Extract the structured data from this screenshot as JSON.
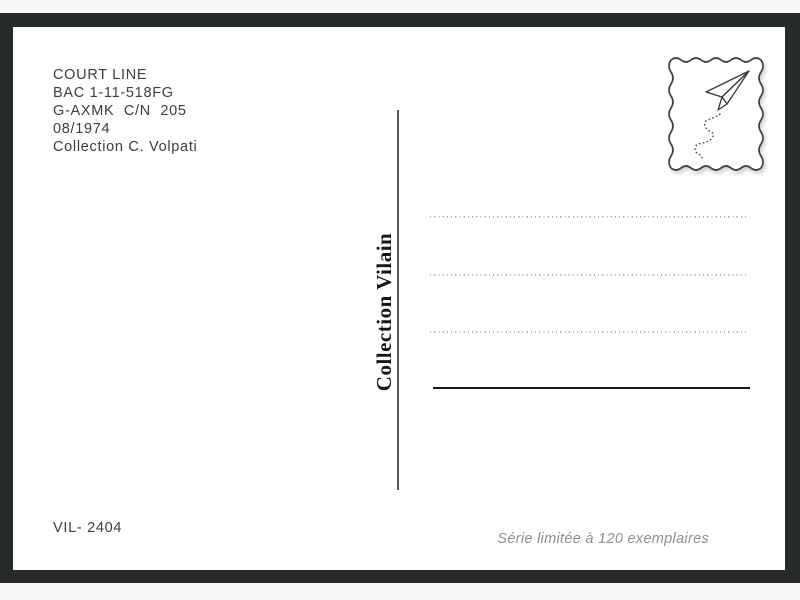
{
  "colors": {
    "photo_background": "#272b27",
    "card": "#ffffff",
    "text": "#3d3d3d",
    "muted_text": "#8f8f8f",
    "spine_text": "#161616"
  },
  "postcard": {
    "info_lines": [
      "COURT LINE",
      "BAC 1-11-518FG",
      "G-AXMK  C/N  205",
      "08/1974",
      "Collection C. Volpati"
    ],
    "spine_label": "Collection Vilain",
    "reference": "VIL- 2404",
    "edition_note": "Série limitée à 120 exemplaires",
    "stamp_icon": "paper-plane-icon",
    "address_dotted_lines": 3
  }
}
